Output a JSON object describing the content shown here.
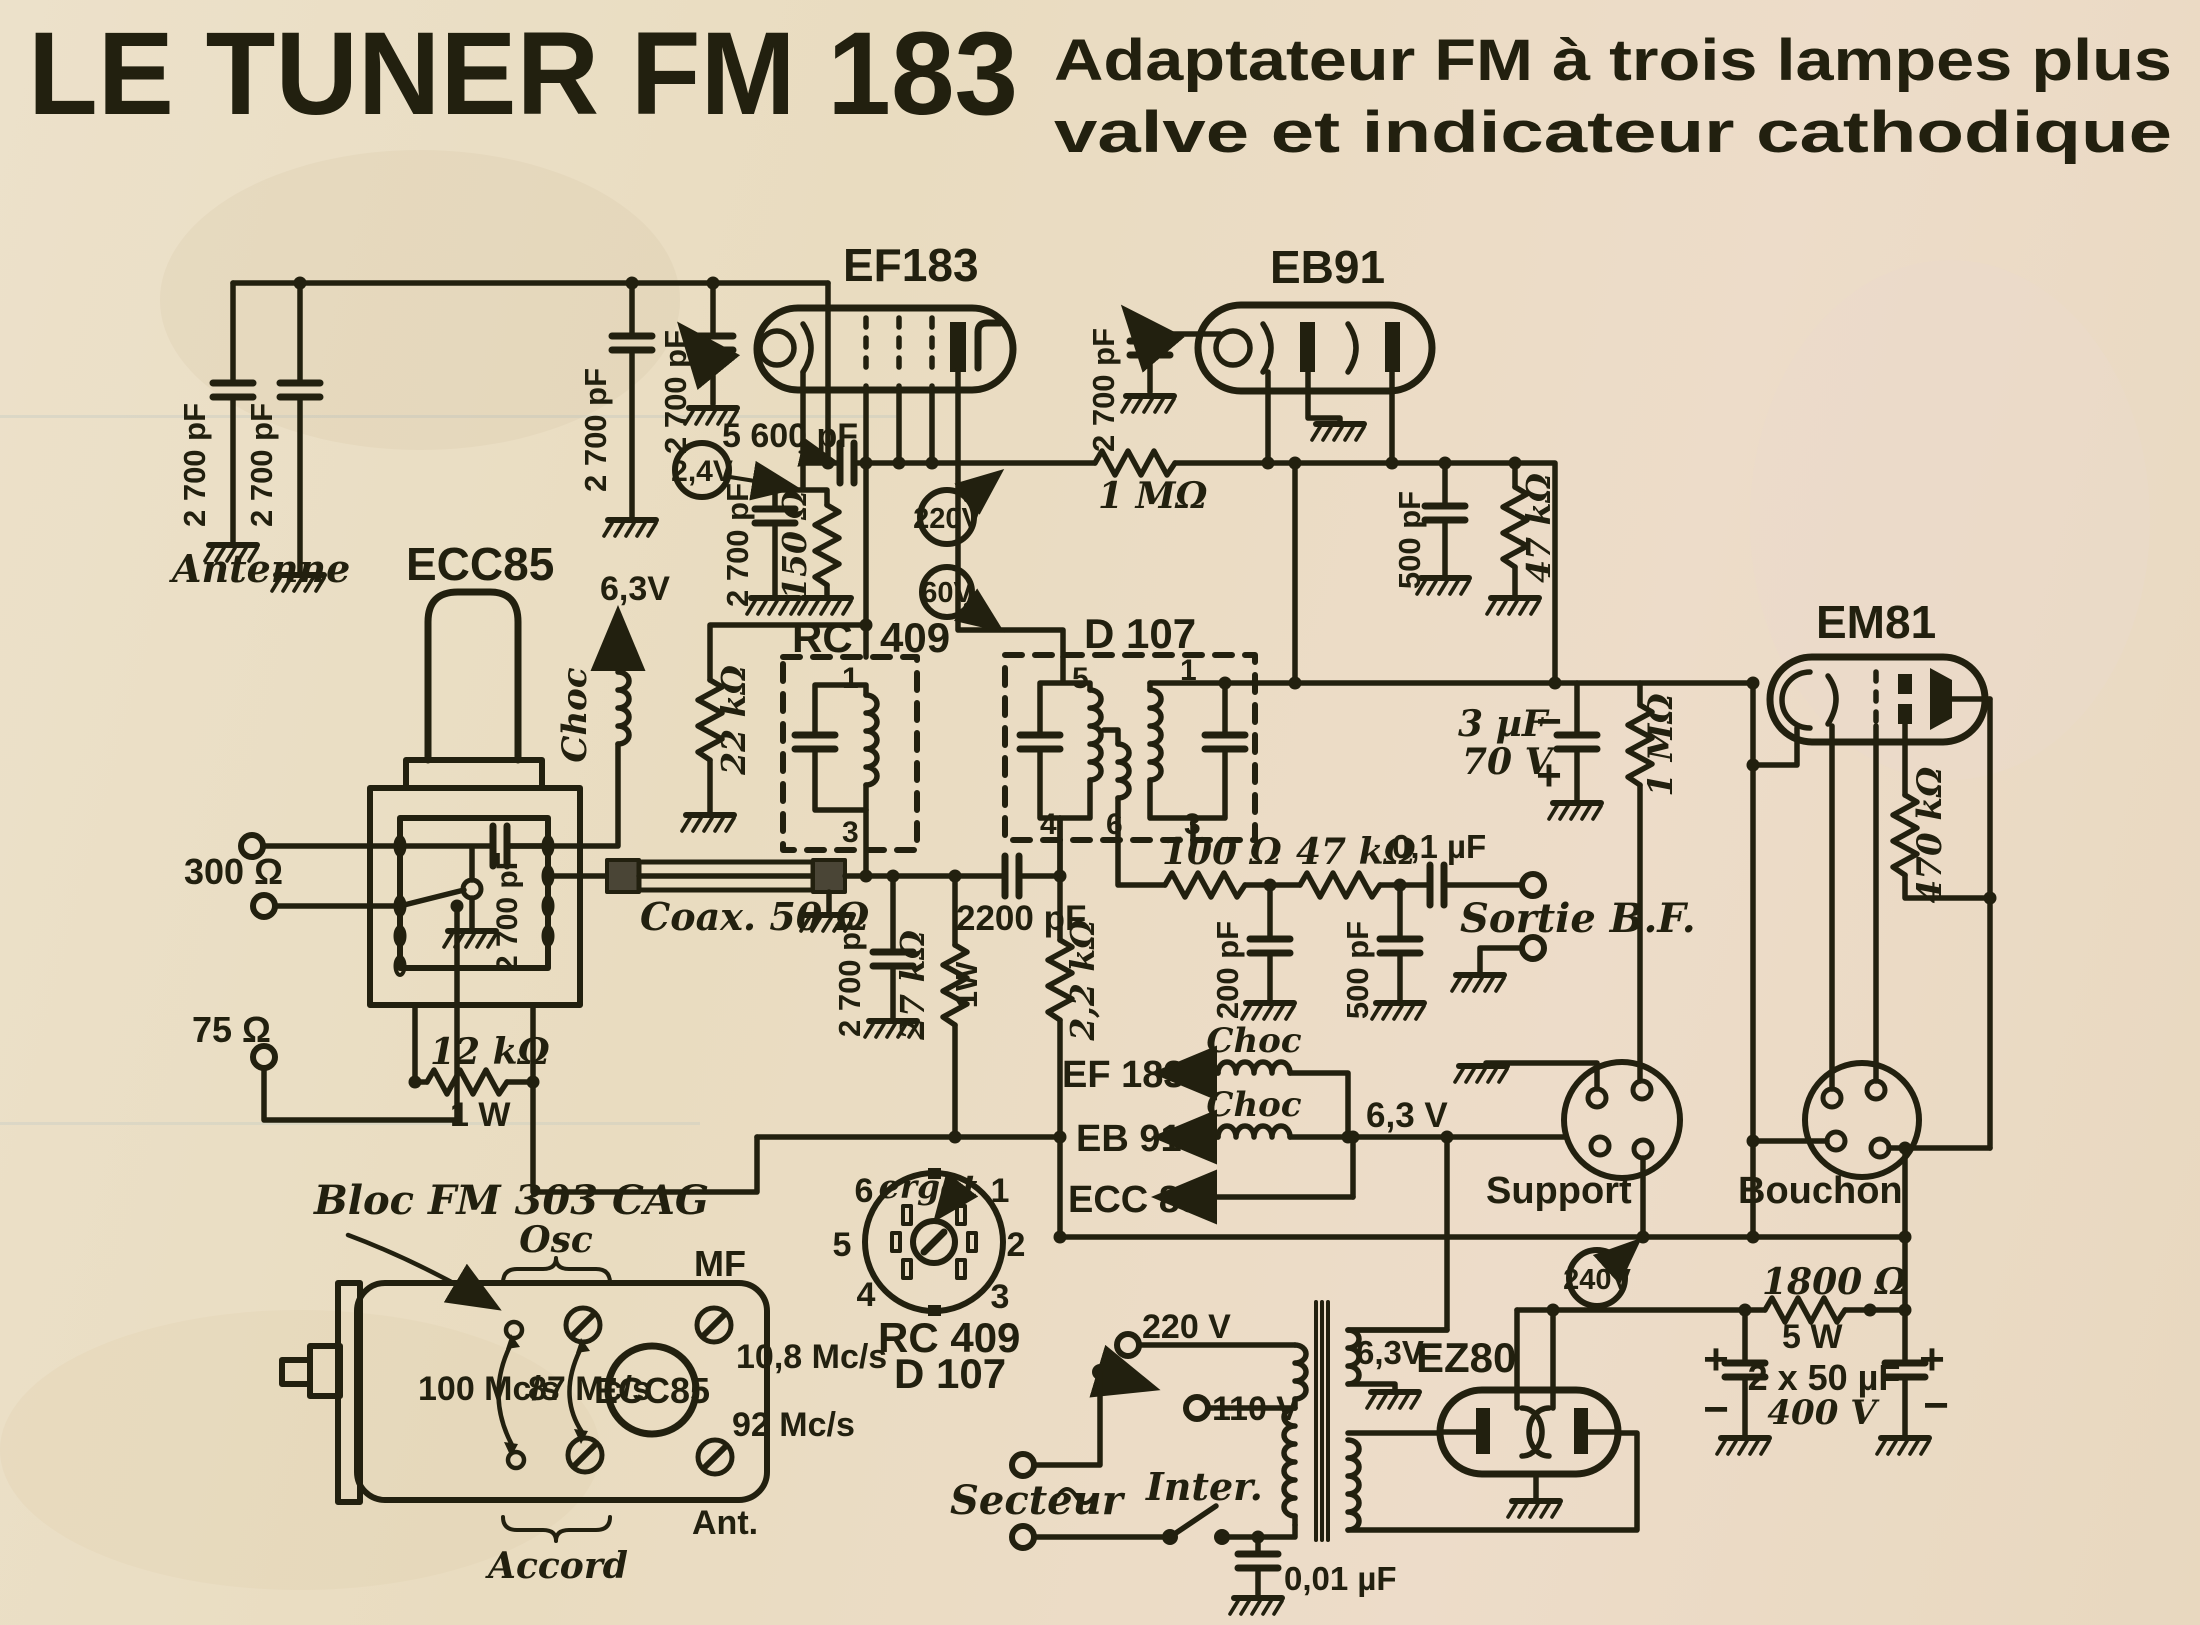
{
  "header": {
    "title": "LE TUNER FM 183",
    "subtitle1": "Adaptateur FM à trois lampes plus",
    "subtitle2": "valve et indicateur cathodique"
  },
  "tubes": {
    "ef183": "EF183",
    "eb91": "EB91",
    "ecc85": "ECC85",
    "em81": "EM81",
    "ez80": "EZ80",
    "ecc85_bloc": "ECC85"
  },
  "volt": {
    "v24": "2,4V",
    "v220": "220V",
    "v60": "60V",
    "v240": "240V",
    "v63_choke": "6,3V",
    "v63_bus": "6,3 V",
    "v63_tr": "6,3V",
    "v220_tap": "220 V",
    "v110_tap": "110 V"
  },
  "comp": {
    "c2700_a": "2 700 pF",
    "c2700_b": "2 700 pF",
    "c2700_c": "2 700 pF",
    "c2700_d": "2 700 pF",
    "c2700_cath": "2 700 pF",
    "c2700_bloc": "2 700 pF",
    "c2700_eb91": "2 700 pF",
    "c2700_coax": "2 700 pF",
    "c5600": "5 600 pF",
    "r150": "150 Ω",
    "r22k": "22 kΩ",
    "r1m_a": "1 MΩ",
    "c500_a": "500 pF",
    "r47k_a": "47 kΩ",
    "r12k": "12 kΩ",
    "r12k_w": "1 W",
    "c2200": "2200 pF",
    "r27k": "27 kΩ",
    "r27k_w": "1W",
    "r2k2": "2,2 kΩ",
    "r100": "100 Ω",
    "r47k_b": "47 kΩ",
    "c200": "200 pF",
    "c500_b": "500 pF",
    "c01": "0,1 µF",
    "c3uf": "3 µF",
    "v70": "70 V",
    "r1m_b": "1 MΩ",
    "r470k": "470 kΩ",
    "r1800": "1800 Ω",
    "r1800_w": "5 W",
    "c2x50": "2 x 50 µF",
    "v400": "400 V",
    "c001": "0,01 µF"
  },
  "conn": {
    "antenne": "Antenne",
    "r300": "300 Ω",
    "r75": "75 Ω",
    "coax": "Coax. 50 Ω",
    "sortie": "Sortie B.F.",
    "support": "Support",
    "bouchon": "Bouchon",
    "secteur": "Secteur",
    "inter": "Inter.",
    "ergot": "ergot"
  },
  "bloc": {
    "label": "Bloc FM 303 CAG",
    "osc": "Osc",
    "mf": "MF",
    "accord": "Accord",
    "ant": "Ant.",
    "f100": "100 Mc/s",
    "f87": "87 Mc/s",
    "f108": "10,8 Mc/s",
    "f92": "92 Mc/s"
  },
  "heat": {
    "ef183": "EF 183",
    "eb91": "EB 91",
    "ecc85": "ECC 85",
    "choc1": "Choc",
    "choc2": "Choc",
    "choc_l": "Choc"
  },
  "ifcan": {
    "rc": "RC",
    "num": "409",
    "d107": "D 107",
    "p1": "1",
    "p3": "3",
    "d5": "5",
    "d1": "1",
    "d4": "4",
    "d6": "6",
    "d3": "3"
  },
  "socket": {
    "rc409": "RC 409",
    "d107": "D 107",
    "p1": "1",
    "p2": "2",
    "p3": "3",
    "p4": "4",
    "p5": "5",
    "p6": "6"
  },
  "signs": {
    "plus": "+",
    "minus": "−"
  }
}
